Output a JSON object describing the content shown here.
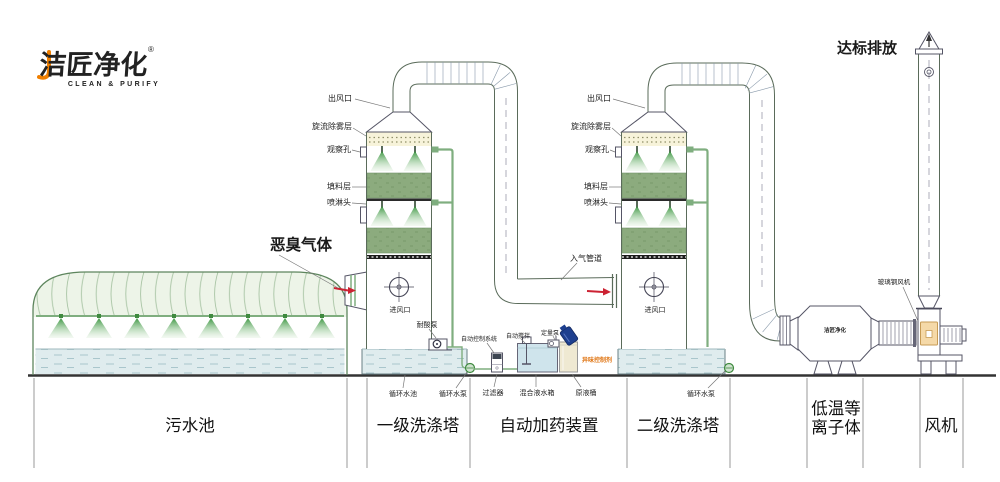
{
  "logo": {
    "brand": "洁匠净化",
    "registered": "®",
    "tagline": "CLEAN & PURIFY"
  },
  "headline": {
    "discharge": "达标排放",
    "odor_gas": "恶臭气体"
  },
  "tower_labels": {
    "outlet": "出风口",
    "demister": "旋流除雾层",
    "observe": "观察孔",
    "packing": "填料层",
    "spray_head": "喷淋头",
    "air_inlet": "进风口"
  },
  "tower1": {
    "acid_pump": "耐酸泵"
  },
  "tower2": {
    "gas_pipe": "入气管道",
    "circ_pump": "循环水泵"
  },
  "pool1": {
    "circ_pool": "循环水池",
    "circ_pump": "循环水泵"
  },
  "dosing": {
    "control_system": "自动控制系统",
    "auto_stir": "自动搅拌",
    "meter_pump": "定量泵",
    "odor_agent": "异味控制剂",
    "filter": "过滤器",
    "mix_tank": "混合液水箱",
    "stock_barrel": "原液桶"
  },
  "right_side": {
    "frp_fan": "玻璃钢风机",
    "plasma_brand": "洁匠净化"
  },
  "sections": {
    "pool": "污水池",
    "tower1": "一级洗涤塔",
    "dosing": "自动加药装置",
    "tower2": "二级洗涤塔",
    "plasma_line1": "低温等",
    "plasma_line2": "离子体",
    "fan": "风机"
  },
  "colors": {
    "brand_green": "#2b9e37",
    "logo_orange": "#f07f00",
    "packing_green": "#8cab7e",
    "water_blue": "#dfecee",
    "agent_orange": "#e07818",
    "arrow_red": "#cc2233",
    "barrel_blue": "#1e3f8f"
  }
}
